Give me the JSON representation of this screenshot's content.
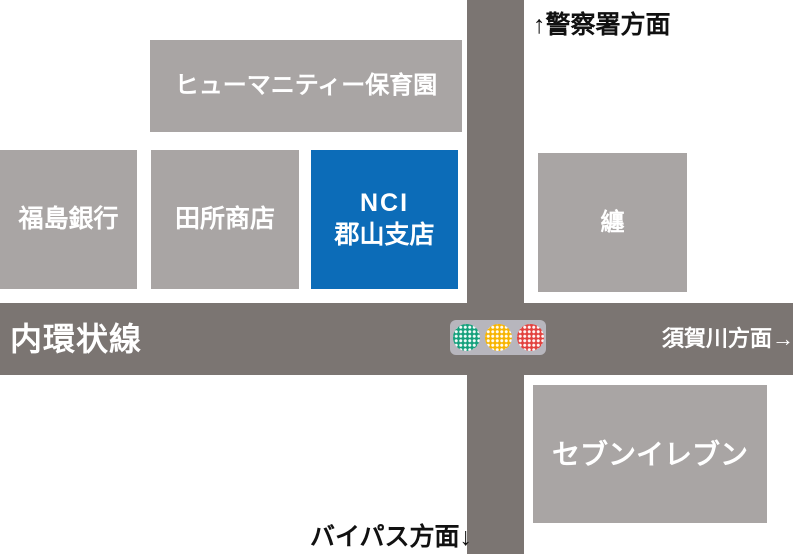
{
  "map": {
    "road_name": "内環状線",
    "directions": {
      "north": "↑警察署方面",
      "east": "須賀川方面→",
      "south": "バイパス方面↓"
    },
    "buildings": {
      "nursery": {
        "label": "ヒューマニティー保育園"
      },
      "bank": {
        "label": "福島銀行"
      },
      "shop": {
        "label": "田所商店"
      },
      "nci": {
        "label_line1": "NCI",
        "label_line2": "郡山支店",
        "highlighted": true
      },
      "matoi": {
        "label": "纏"
      },
      "seven_eleven": {
        "label": "セブンイレブン"
      }
    },
    "traffic_light": {
      "lights": [
        "green",
        "yellow",
        "red"
      ],
      "green_color": "#14a07c",
      "yellow_color": "#f7b400",
      "red_color": "#e2413e",
      "box_color": "#b7b6bd"
    },
    "colors": {
      "background": "#ffffff",
      "building_gray": "#a9a5a4",
      "road_gray": "#7b7572",
      "highlight_blue": "#0c6cb8",
      "text_white": "#ffffff",
      "text_black": "#111111"
    }
  }
}
